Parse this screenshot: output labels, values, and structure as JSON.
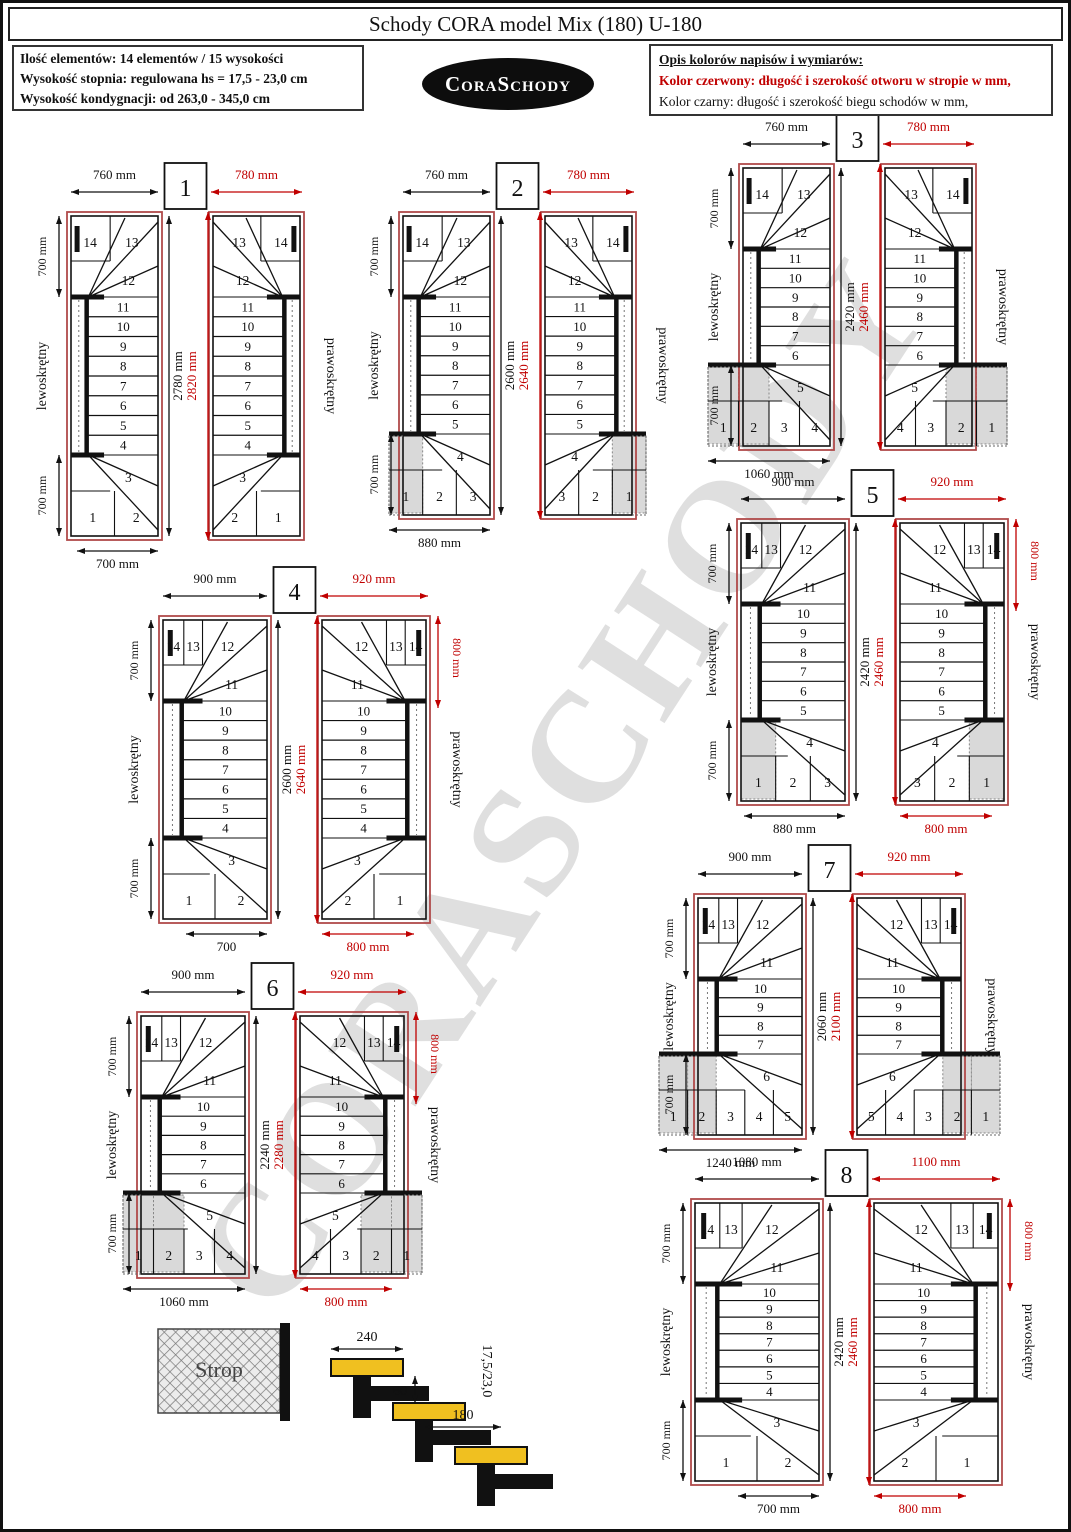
{
  "header": {
    "title": "Schody CORA model Mix (180) U-180",
    "info_lines": [
      "Ilość elementów: 14 elementów / 15 wysokości",
      "Wysokość stopnia: regulowana  hs = 17,5 - 23,0 cm",
      "Wysokość kondygnacji: od 263,0 - 345,0 cm"
    ],
    "logo": "CoraSchody",
    "legend": {
      "heading": "Opis kolorów napisów i wymiarów:",
      "red_line": "Kolor czerwony:  długość i szerokość otworu w stropie w mm,",
      "black_line": "Kolor czarny:  długość i szerokość biegu schodów w mm,"
    }
  },
  "watermark": "CORASCHODY",
  "colors": {
    "red": "#c00000",
    "red_rect": "#b04a4a",
    "black": "#111111",
    "shade": "#d9d9d9",
    "tread_yellow": "#f0c020"
  },
  "stair_labels": {
    "left": "lewoskrętny",
    "right": "prawoskrętny"
  },
  "diagrams": [
    {
      "number": "1",
      "top_black": {
        "mm": 760,
        "label": "760 mm"
      },
      "top_red": {
        "mm": 780,
        "label": "780 mm"
      },
      "length_black": {
        "mm": 2780,
        "label": "2780 mm"
      },
      "length_red": {
        "mm": 2820,
        "label": "2820 mm"
      },
      "side_top": {
        "mm": 700,
        "label": "700 mm"
      },
      "side_bottom": {
        "mm": 700,
        "label": "700 mm"
      },
      "bottom_black": {
        "mm": 700,
        "label": "700 mm"
      },
      "bottom_red": null,
      "right_red": null,
      "top_row": [
        "14",
        "13"
      ],
      "top_step": "12",
      "mid_steps": [
        "11",
        "10",
        "9",
        "8",
        "7",
        "6",
        "5",
        "4"
      ],
      "bottom_step": "3",
      "bottom_row": [
        "1",
        "2"
      ],
      "shaded": 0
    },
    {
      "number": "2",
      "top_black": {
        "mm": 760,
        "label": "760 mm"
      },
      "top_red": {
        "mm": 780,
        "label": "780 mm"
      },
      "length_black": {
        "mm": 2600,
        "label": "2600 mm"
      },
      "length_red": {
        "mm": 2640,
        "label": "2640 mm"
      },
      "side_top": {
        "mm": 700,
        "label": "700 mm"
      },
      "side_bottom": {
        "mm": 700,
        "label": "700 mm"
      },
      "bottom_black": {
        "mm": 880,
        "label": "880 mm"
      },
      "bottom_red": null,
      "right_red": null,
      "top_row": [
        "14",
        "13"
      ],
      "top_step": "12",
      "mid_steps": [
        "11",
        "10",
        "9",
        "8",
        "7",
        "6",
        "5"
      ],
      "bottom_step": "4",
      "bottom_row": [
        "1",
        "2",
        "3"
      ],
      "shaded": 1
    },
    {
      "number": "3",
      "top_black": {
        "mm": 760,
        "label": "760 mm"
      },
      "top_red": {
        "mm": 780,
        "label": "780 mm"
      },
      "length_black": {
        "mm": 2420,
        "label": "2420 mm"
      },
      "length_red": {
        "mm": 2460,
        "label": "2460 mm"
      },
      "side_top": {
        "mm": 700,
        "label": "700 mm"
      },
      "side_bottom": {
        "mm": 700,
        "label": "700 mm"
      },
      "bottom_black": {
        "mm": 1060,
        "label": "1060 mm"
      },
      "bottom_red": null,
      "right_red": null,
      "top_row": [
        "14",
        "13"
      ],
      "top_step": "12",
      "mid_steps": [
        "11",
        "10",
        "9",
        "8",
        "7",
        "6"
      ],
      "bottom_step": "5",
      "bottom_row": [
        "1",
        "2",
        "3",
        "4"
      ],
      "shaded": 2
    },
    {
      "number": "4",
      "top_black": {
        "mm": 900,
        "label": "900 mm"
      },
      "top_red": {
        "mm": 920,
        "label": "920 mm"
      },
      "length_black": {
        "mm": 2600,
        "label": "2600 mm"
      },
      "length_red": {
        "mm": 2640,
        "label": "2640 mm"
      },
      "side_top": {
        "mm": 700,
        "label": "700 mm"
      },
      "side_bottom": {
        "mm": 700,
        "label": "700 mm"
      },
      "bottom_black": {
        "mm": 700,
        "label": "700"
      },
      "bottom_red": {
        "mm": 800,
        "label": "800 mm"
      },
      "right_red": {
        "mm": 800,
        "label": "800 mm"
      },
      "top_row": [
        "14",
        "13",
        "12"
      ],
      "top_step": "11",
      "mid_steps": [
        "10",
        "9",
        "8",
        "7",
        "6",
        "5",
        "4"
      ],
      "bottom_step": "3",
      "bottom_row": [
        "1",
        "2"
      ],
      "shaded": 0
    },
    {
      "number": "5",
      "top_black": {
        "mm": 900,
        "label": "900 mm"
      },
      "top_red": {
        "mm": 920,
        "label": "920 mm"
      },
      "length_black": {
        "mm": 2420,
        "label": "2420 mm"
      },
      "length_red": {
        "mm": 2460,
        "label": "2460 mm"
      },
      "side_top": {
        "mm": 700,
        "label": "700 mm"
      },
      "side_bottom": {
        "mm": 700,
        "label": "700 mm"
      },
      "bottom_black": {
        "mm": 880,
        "label": "880 mm"
      },
      "bottom_red": {
        "mm": 800,
        "label": "800 mm"
      },
      "right_red": {
        "mm": 800,
        "label": "800 mm"
      },
      "top_row": [
        "14",
        "13",
        "12"
      ],
      "top_step": "11",
      "mid_steps": [
        "10",
        "9",
        "8",
        "7",
        "6",
        "5"
      ],
      "bottom_step": "4",
      "bottom_row": [
        "1",
        "2",
        "3"
      ],
      "shaded": 1
    },
    {
      "number": "6",
      "top_black": {
        "mm": 900,
        "label": "900 mm"
      },
      "top_red": {
        "mm": 920,
        "label": "920 mm"
      },
      "length_black": {
        "mm": 2240,
        "label": "2240 mm"
      },
      "length_red": {
        "mm": 2280,
        "label": "2280 mm"
      },
      "side_top": {
        "mm": 700,
        "label": "700 mm"
      },
      "side_bottom": {
        "mm": 700,
        "label": "700 mm"
      },
      "bottom_black": {
        "mm": 1060,
        "label": "1060 mm"
      },
      "bottom_red": {
        "mm": 800,
        "label": "800 mm"
      },
      "right_red": {
        "mm": 800,
        "label": "800 mm"
      },
      "top_row": [
        "14",
        "13",
        "12"
      ],
      "top_step": "11",
      "mid_steps": [
        "10",
        "9",
        "8",
        "7",
        "6"
      ],
      "bottom_step": "5",
      "bottom_row": [
        "1",
        "2",
        "3",
        "4"
      ],
      "shaded": 2
    },
    {
      "number": "7",
      "top_black": {
        "mm": 900,
        "label": "900 mm"
      },
      "top_red": {
        "mm": 920,
        "label": "920 mm"
      },
      "length_black": {
        "mm": 2060,
        "label": "2060 mm"
      },
      "length_red": {
        "mm": 2100,
        "label": "2100 mm"
      },
      "side_top": {
        "mm": 700,
        "label": "700 mm"
      },
      "side_bottom": {
        "mm": 700,
        "label": "700 mm"
      },
      "bottom_black": {
        "mm": 1240,
        "label": "1240 mm"
      },
      "bottom_red": null,
      "right_red": null,
      "top_row": [
        "14",
        "13",
        "12"
      ],
      "top_step": "11",
      "mid_steps": [
        "10",
        "9",
        "8",
        "7"
      ],
      "bottom_step": "6",
      "bottom_row": [
        "1",
        "2",
        "3",
        "4",
        "5"
      ],
      "shaded": 2
    },
    {
      "number": "8",
      "top_black": {
        "mm": 1080,
        "label": "1080 mm"
      },
      "top_red": {
        "mm": 1100,
        "label": "1100 mm"
      },
      "length_black": {
        "mm": 2420,
        "label": "2420 mm"
      },
      "length_red": {
        "mm": 2460,
        "label": "2460 mm"
      },
      "side_top": {
        "mm": 700,
        "label": "700 mm"
      },
      "side_bottom": {
        "mm": 700,
        "label": "700 mm"
      },
      "bottom_black": {
        "mm": 700,
        "label": "700 mm"
      },
      "bottom_red": {
        "mm": 800,
        "label": "800 mm"
      },
      "right_red": {
        "mm": 800,
        "label": "800 mm"
      },
      "top_row": [
        "14",
        "13",
        "12"
      ],
      "top_step": "11",
      "mid_steps": [
        "10",
        "9",
        "8",
        "7",
        "6",
        "5",
        "4"
      ],
      "bottom_step": "3",
      "bottom_row": [
        "1",
        "2"
      ],
      "shaded": 0
    }
  ],
  "sideview": {
    "strop_label": "Strop",
    "dim_tread": "240",
    "dim_overlap": "60",
    "dim_depth": "180",
    "dim_rise": "17,5/23,0"
  }
}
